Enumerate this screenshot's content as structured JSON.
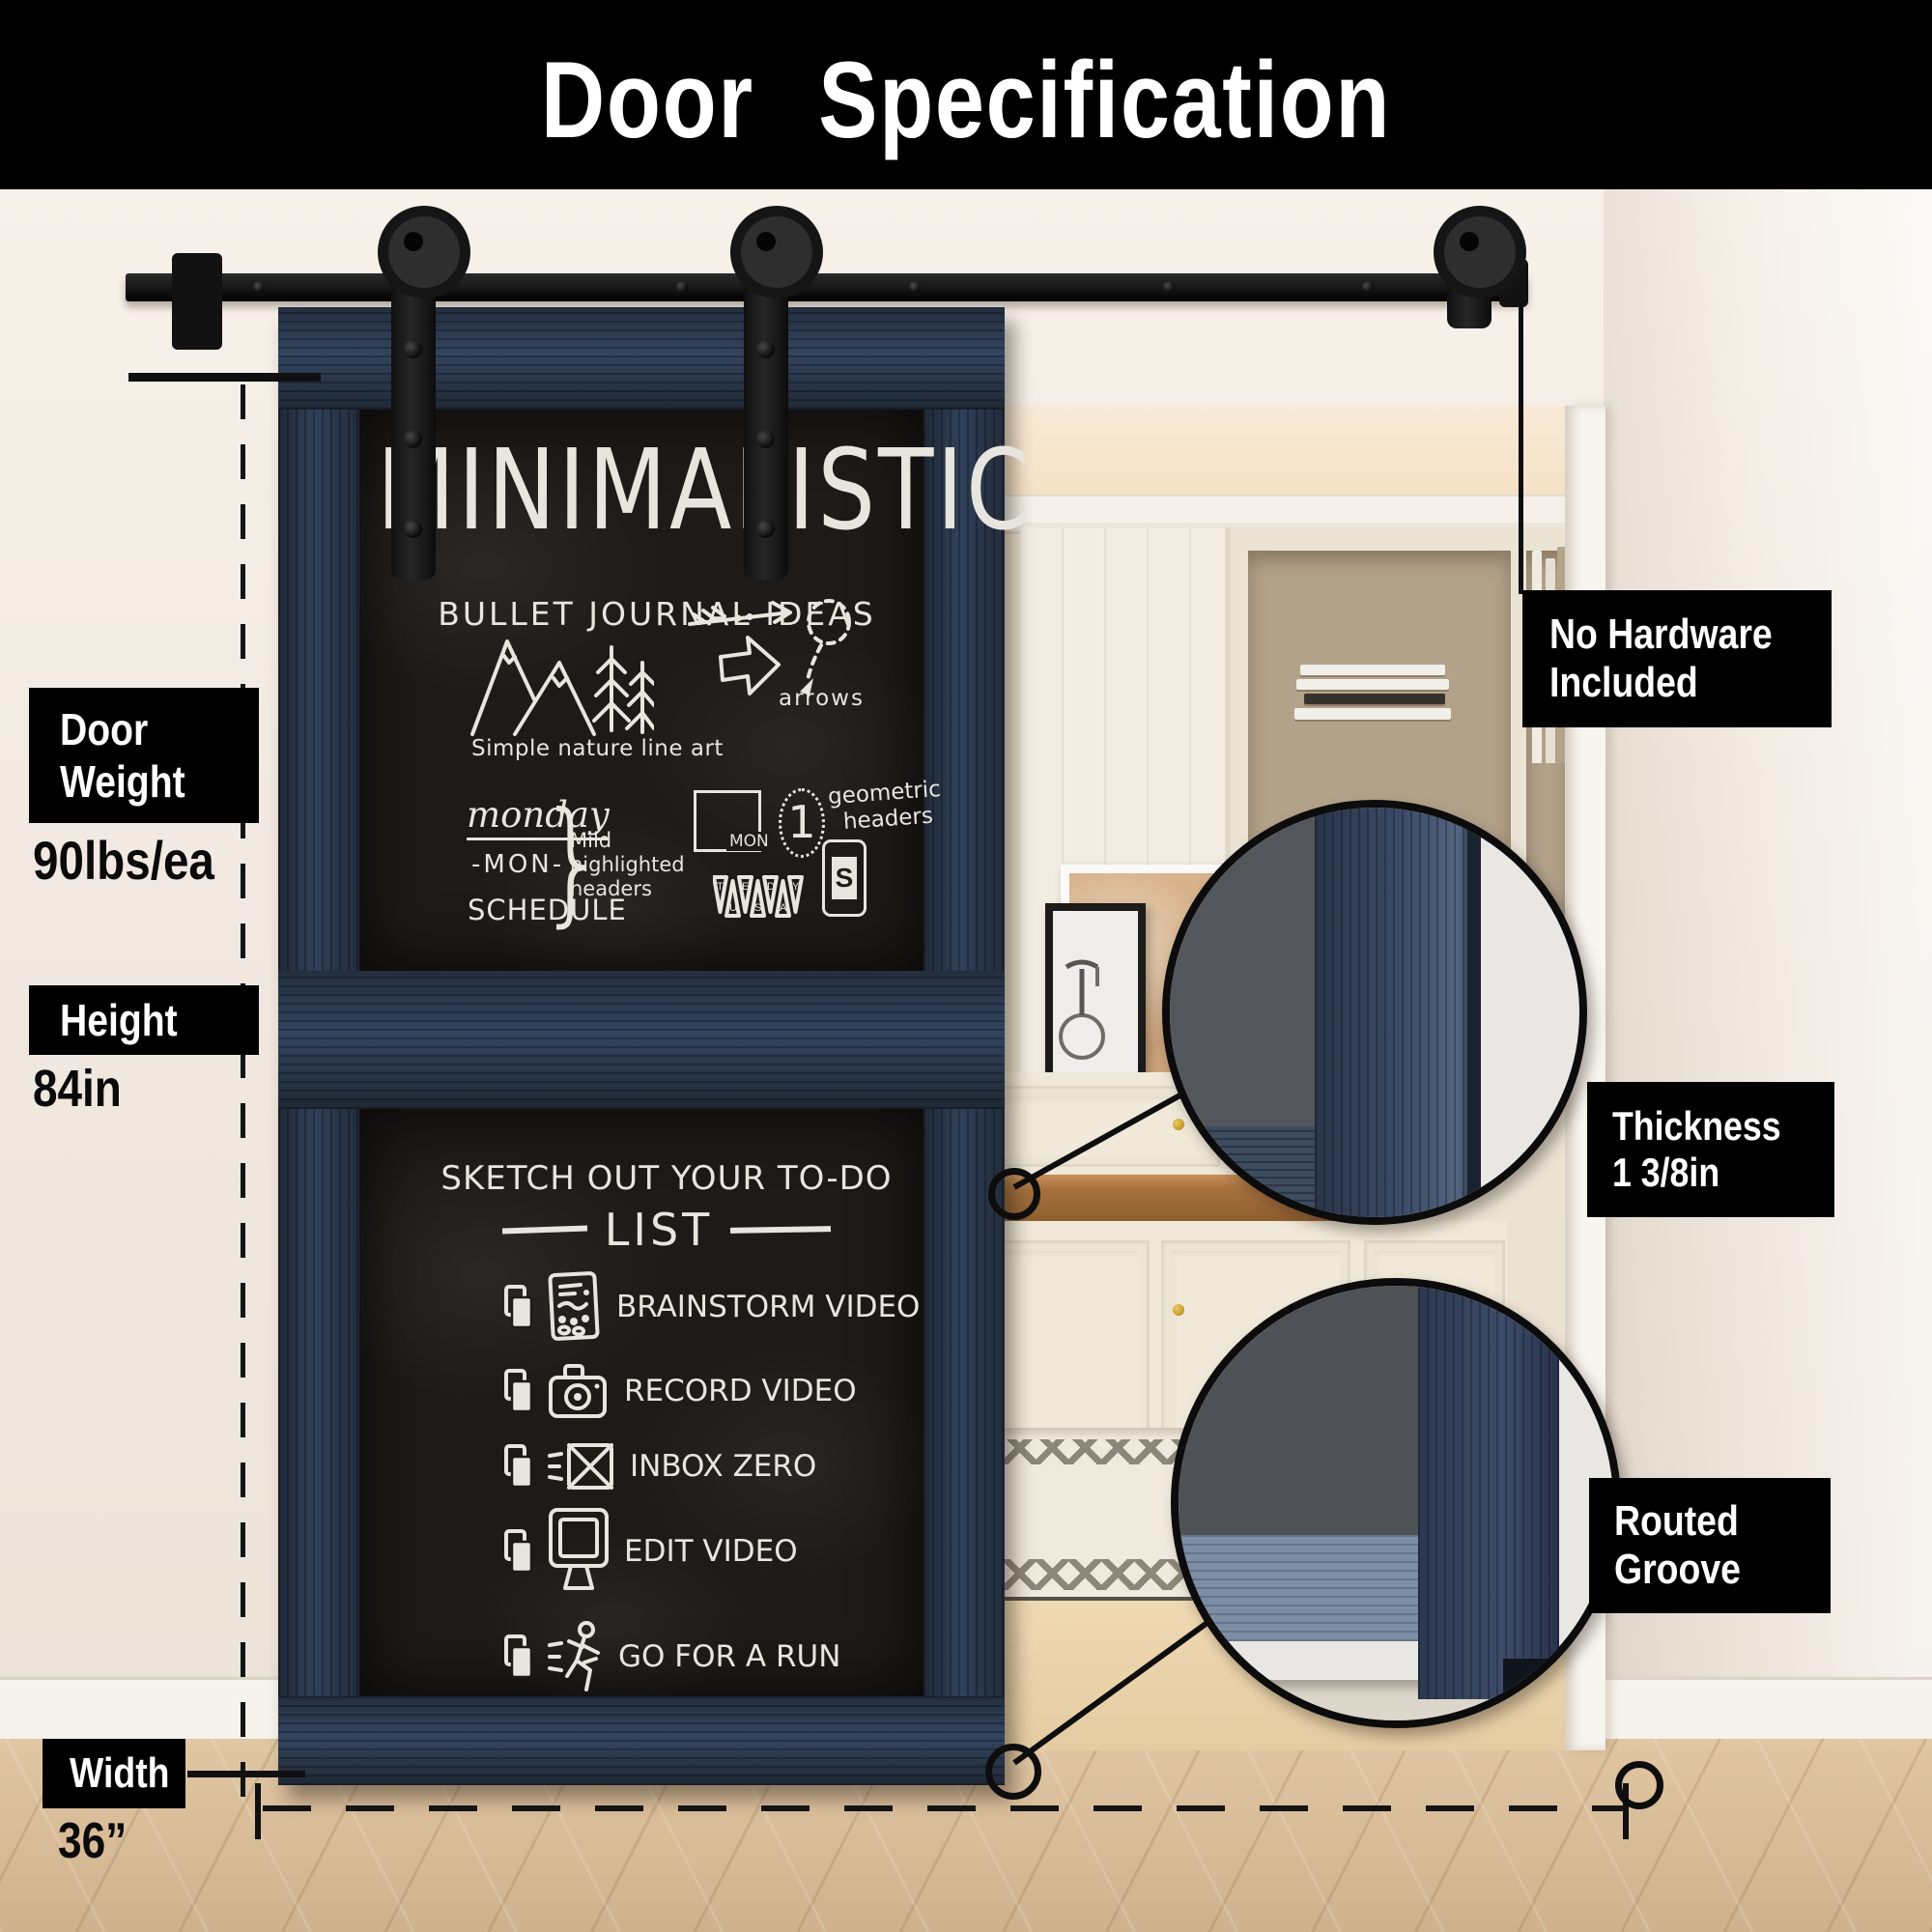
{
  "title": "Door Specification",
  "measurements": {
    "door_weight": {
      "label_lines": [
        "Door",
        "Weight"
      ],
      "value": "90lbs/ea"
    },
    "height": {
      "label": "Height",
      "value": "84in"
    },
    "width": {
      "label": "Width",
      "value": "36”"
    }
  },
  "callouts": {
    "no_hardware": {
      "lines": [
        "No Hardware",
        "Included"
      ]
    },
    "thickness": {
      "lines": [
        "Thickness",
        "1  3/8in"
      ]
    },
    "routed_groove": {
      "lines": [
        "Routed",
        "Groove"
      ]
    }
  },
  "board_top": {
    "title": "MINIMALISTIC",
    "subtitle": "BULLET JOURNAL IDEAS",
    "nature_caption": "Simple nature line art",
    "arrows_caption": "arrows",
    "monday": "monday",
    "mon_dashes": "-MON-",
    "schedule": "SCHEDULE",
    "brace": "}",
    "note_lines": [
      "Mild",
      "highlighted",
      "headers"
    ],
    "geo_lines": [
      "geometric",
      "headers"
    ],
    "rect_label": "MON",
    "one": "1",
    "pennant_letters": [
      "T",
      "U",
      "E",
      "S",
      "D",
      "A",
      "Y"
    ],
    "badge": "S"
  },
  "board_bottom": {
    "title": "SKETCH OUT YOUR TO-DO",
    "list_word": "LIST",
    "items": [
      "BRAINSTORM VIDEO",
      "RECORD VIDEO",
      "INBOX ZERO",
      "EDIT VIDEO",
      "GO FOR A RUN"
    ]
  },
  "colors": {
    "banner": "#000000",
    "door_navy": "#2b3647",
    "chalkboard": "#1d1a17",
    "chalk": "#e8e5df",
    "hardware_black": "#141414",
    "wall": "#f1e9e1",
    "floor_wood": "#d8bb97",
    "brass_knob": "#c9a22a"
  }
}
